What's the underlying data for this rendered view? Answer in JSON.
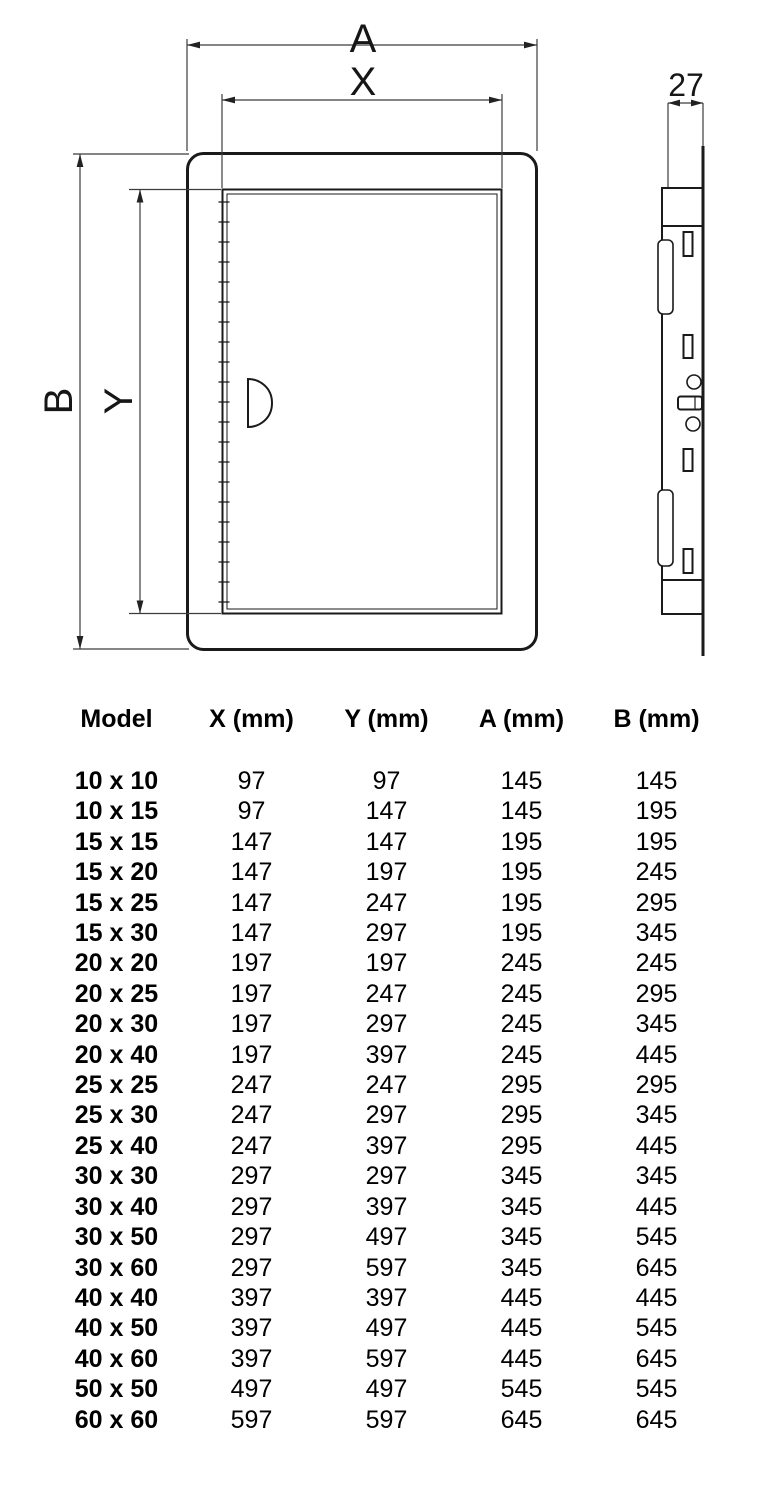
{
  "colors": {
    "background": "#ffffff",
    "drawing_line": "#1a1a1a",
    "dimension_line": "#3c3c3c",
    "table_text": "#000000"
  },
  "diagram": {
    "front_view": {
      "outer_width_label": "A",
      "inner_width_label": "X",
      "outer_height_label": "B",
      "inner_height_label": "Y"
    },
    "side_view": {
      "depth_label": "27"
    }
  },
  "table": {
    "columns": [
      "Model",
      "X (mm)",
      "Y (mm)",
      "A (mm)",
      "B (mm)"
    ],
    "rows": [
      [
        "10 x 10",
        "97",
        "97",
        "145",
        "145"
      ],
      [
        "10 x 15",
        "97",
        "147",
        "145",
        "195"
      ],
      [
        "15 x 15",
        "147",
        "147",
        "195",
        "195"
      ],
      [
        "15 x 20",
        "147",
        "197",
        "195",
        "245"
      ],
      [
        "15 x 25",
        "147",
        "247",
        "195",
        "295"
      ],
      [
        "15 x 30",
        "147",
        "297",
        "195",
        "345"
      ],
      [
        "20 x 20",
        "197",
        "197",
        "245",
        "245"
      ],
      [
        "20 x 25",
        "197",
        "247",
        "245",
        "295"
      ],
      [
        "20 x 30",
        "197",
        "297",
        "245",
        "345"
      ],
      [
        "20 x 40",
        "197",
        "397",
        "245",
        "445"
      ],
      [
        "25 x 25",
        "247",
        "247",
        "295",
        "295"
      ],
      [
        "25 x 30",
        "247",
        "297",
        "295",
        "345"
      ],
      [
        "25 x 40",
        "247",
        "397",
        "295",
        "445"
      ],
      [
        "30 x 30",
        "297",
        "297",
        "345",
        "345"
      ],
      [
        "30 x 40",
        "297",
        "397",
        "345",
        "445"
      ],
      [
        "30 x 50",
        "297",
        "497",
        "345",
        "545"
      ],
      [
        "30 x 60",
        "297",
        "597",
        "345",
        "645"
      ],
      [
        "40 x 40",
        "397",
        "397",
        "445",
        "445"
      ],
      [
        "40 x 50",
        "397",
        "497",
        "445",
        "545"
      ],
      [
        "40 x 60",
        "397",
        "597",
        "445",
        "645"
      ],
      [
        "50 x 50",
        "497",
        "497",
        "545",
        "545"
      ],
      [
        "60 x 60",
        "597",
        "597",
        "645",
        "645"
      ]
    ]
  }
}
